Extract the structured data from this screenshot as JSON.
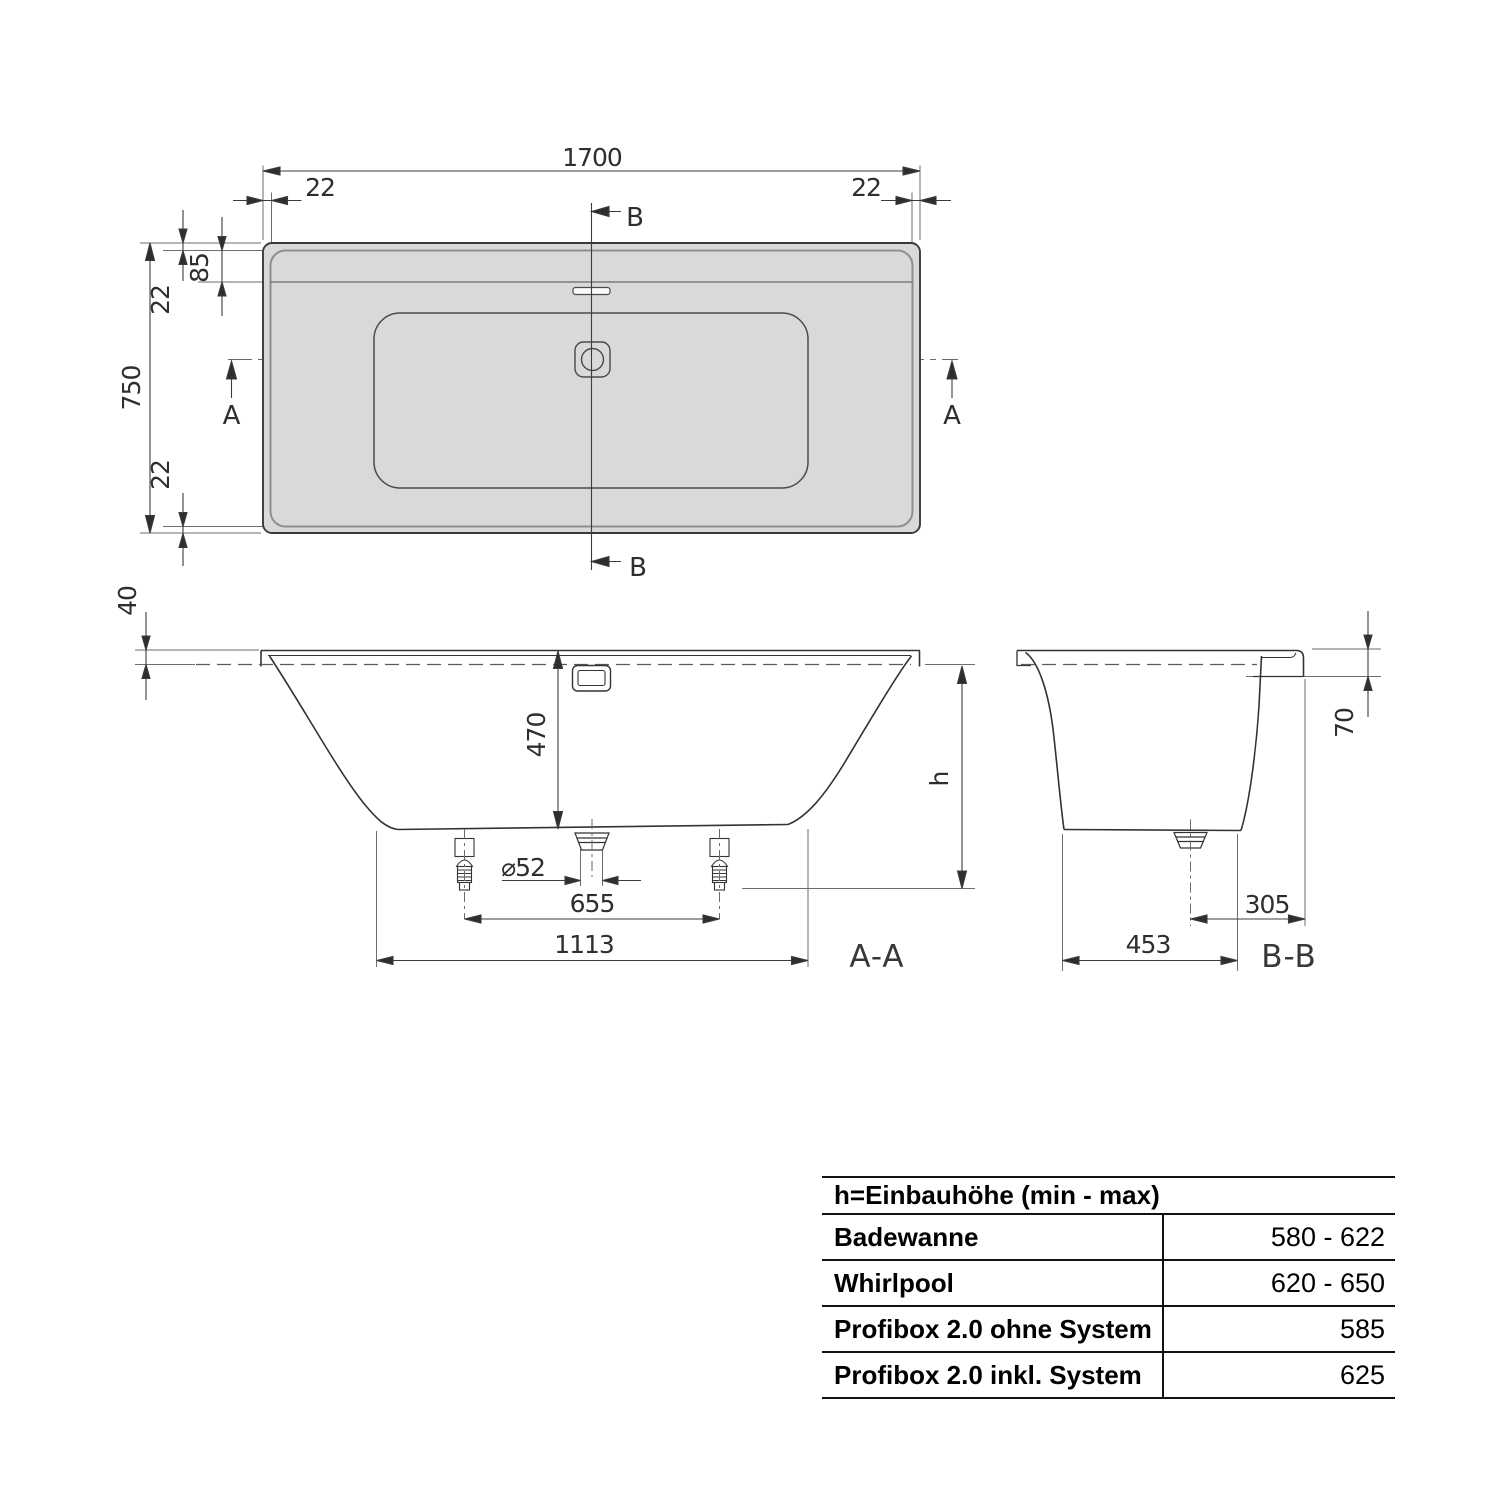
{
  "drawing": {
    "plan": {
      "overall_length": "1700",
      "overall_width": "750",
      "rim_left": "22",
      "rim_right": "22",
      "rim_top": "22",
      "rim_bottom": "22",
      "headrest_depth": "85",
      "section_a_label": "A",
      "section_b_label": "B"
    },
    "section_aa": {
      "label": "A-A",
      "rim_height": "40",
      "inner_depth": "470",
      "install_height_var": "h",
      "drain_diameter": "⌀52",
      "feet_spacing": "655",
      "bottom_length": "1113"
    },
    "section_bb": {
      "label": "B-B",
      "rim_drop": "70",
      "drain_offset": "305",
      "bottom_width": "453"
    }
  },
  "table": {
    "header": "h=Einbauhöhe (min - max)",
    "rows": [
      {
        "label": "Badewanne",
        "value": "580 - 622"
      },
      {
        "label": "Whirlpool",
        "value": "620 - 650"
      },
      {
        "label": "Profibox 2.0 ohne System",
        "value": "585"
      },
      {
        "label": "Profibox 2.0 inkl. System",
        "value": "625"
      }
    ]
  },
  "colors": {
    "line": "#2e2e2e",
    "line_soft": "#6e6e6e",
    "tub_fill": "#d9d9d9",
    "background": "#ffffff"
  }
}
